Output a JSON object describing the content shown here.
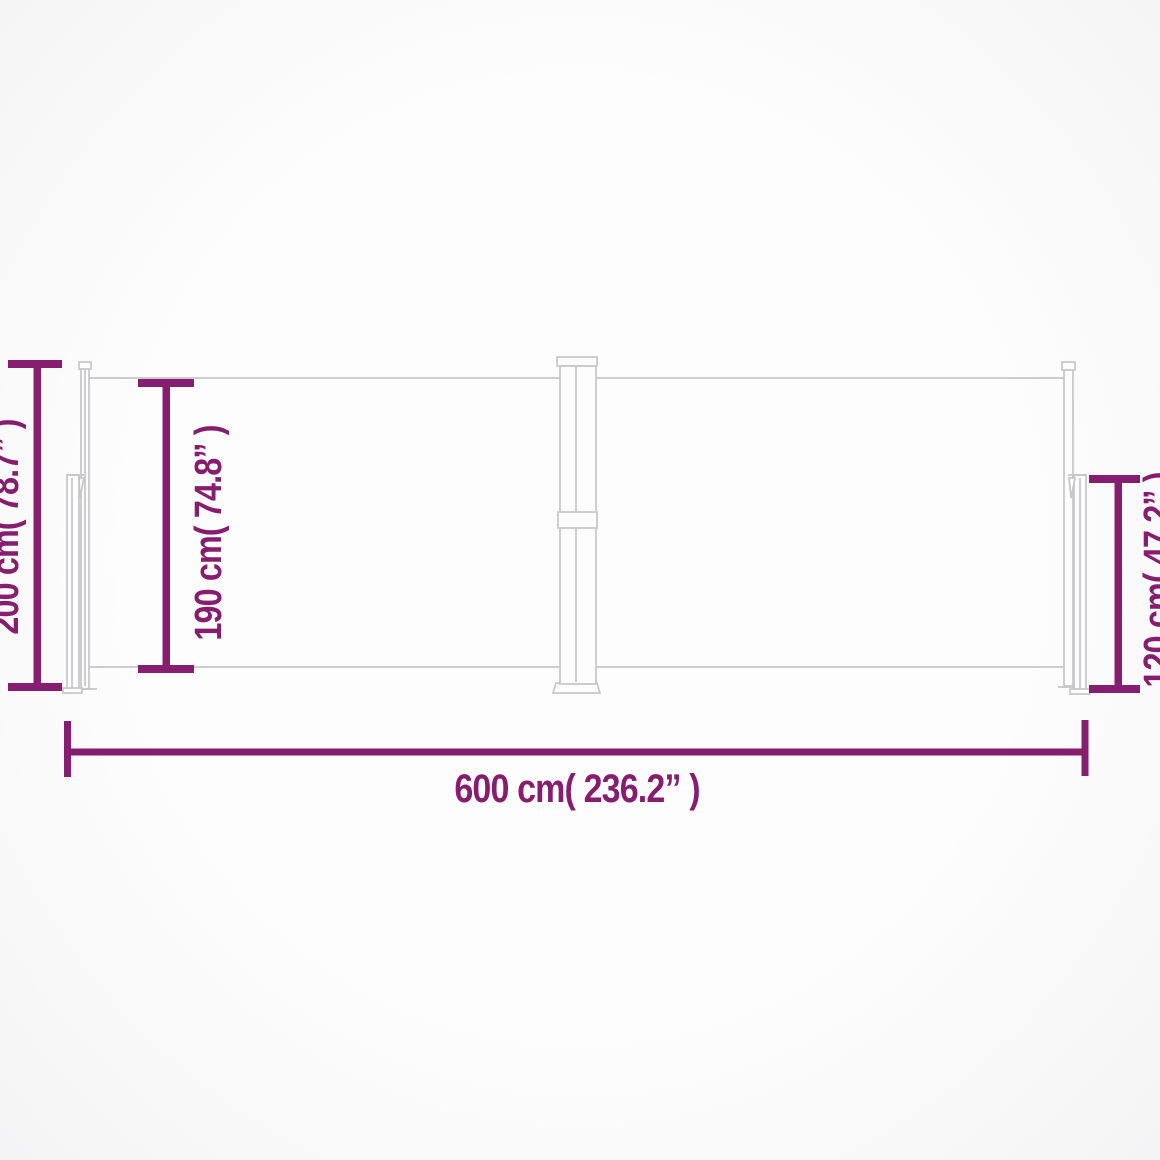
{
  "diagram": {
    "type": "product-dimension-drawing",
    "subject": "retractable double side awning",
    "labels": {
      "total_height": "200 cm( 78.7” )",
      "fabric_height": "190 cm( 74.8” )",
      "end_height": "120 cm( 47.2” )",
      "total_width": "600 cm( 236.2” )"
    },
    "values": {
      "total_height_cm": 200,
      "total_height_in": 78.7,
      "fabric_height_cm": 190,
      "fabric_height_in": 74.8,
      "end_height_cm": 120,
      "end_height_in": 47.2,
      "total_width_cm": 600,
      "total_width_in": 236.2
    }
  },
  "colors": {
    "dimension": "#871d6e",
    "structure": "#c6c6c8",
    "background": "#fcfcfc"
  }
}
